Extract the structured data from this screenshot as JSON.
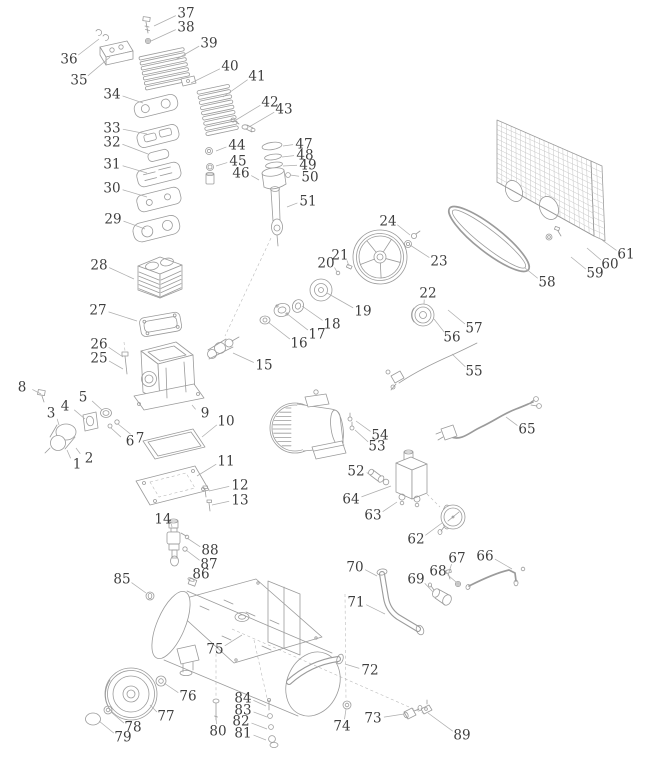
{
  "canvas": {
    "width": 656,
    "height": 768,
    "background": "#ffffff"
  },
  "style": {
    "part_line_color": "#9b9b9b",
    "mesh_line_color": "#c6c6c6",
    "leader_line_color": "#aeaeae",
    "label_color": "#3f3f3f",
    "label_font_size": 13.5
  },
  "diagram": {
    "kind": "exploded-parts-diagram",
    "subject": "belt-driven air compressor exploded view",
    "labels": [
      {
        "n": "1",
        "x": 77,
        "y": 464,
        "tx": 67,
        "ty": 450
      },
      {
        "n": "2",
        "x": 89,
        "y": 458,
        "tx": 76,
        "ty": 448
      },
      {
        "n": "3",
        "x": 51,
        "y": 413,
        "tx": 59,
        "ty": 425
      },
      {
        "n": "4",
        "x": 65,
        "y": 406,
        "tx": 85,
        "ty": 419
      },
      {
        "n": "5",
        "x": 83,
        "y": 397,
        "tx": 102,
        "ty": 410
      },
      {
        "n": "6",
        "x": 130,
        "y": 441,
        "tx": 111,
        "ty": 428
      },
      {
        "n": "7",
        "x": 140,
        "y": 438,
        "tx": 118,
        "ty": 424
      },
      {
        "n": "8",
        "x": 22,
        "y": 387,
        "tx": 41,
        "ty": 394
      },
      {
        "n": "9",
        "x": 205,
        "y": 413,
        "tx": 192,
        "ty": 405
      },
      {
        "n": "10",
        "x": 226,
        "y": 421,
        "tx": 202,
        "ty": 437
      },
      {
        "n": "11",
        "x": 226,
        "y": 461,
        "tx": 197,
        "ty": 476
      },
      {
        "n": "12",
        "x": 240,
        "y": 485,
        "tx": 209,
        "ty": 491
      },
      {
        "n": "13",
        "x": 240,
        "y": 500,
        "tx": 212,
        "ty": 505
      },
      {
        "n": "14",
        "x": 163,
        "y": 519,
        "tx": 172,
        "ty": 527
      },
      {
        "n": "15",
        "x": 264,
        "y": 365,
        "tx": 233,
        "ty": 353
      },
      {
        "n": "16",
        "x": 299,
        "y": 343,
        "tx": 268,
        "ty": 322
      },
      {
        "n": "17",
        "x": 317,
        "y": 334,
        "tx": 286,
        "ty": 313
      },
      {
        "n": "18",
        "x": 332,
        "y": 324,
        "tx": 302,
        "ty": 306
      },
      {
        "n": "19",
        "x": 363,
        "y": 311,
        "tx": 327,
        "ty": 293
      },
      {
        "n": "20",
        "x": 326,
        "y": 263,
        "tx": 337,
        "ty": 272
      },
      {
        "n": "21",
        "x": 340,
        "y": 255,
        "tx": 349,
        "ty": 266
      },
      {
        "n": "22",
        "x": 428,
        "y": 293,
        "tx": 424,
        "ty": 304
      },
      {
        "n": "23",
        "x": 439,
        "y": 261,
        "tx": 410,
        "ty": 245
      },
      {
        "n": "24",
        "x": 388,
        "y": 221,
        "tx": 410,
        "ty": 235
      },
      {
        "n": "25",
        "x": 99,
        "y": 358,
        "tx": 123,
        "ty": 369
      },
      {
        "n": "26",
        "x": 99,
        "y": 344,
        "tx": 123,
        "ty": 357
      },
      {
        "n": "27",
        "x": 98,
        "y": 310,
        "tx": 137,
        "ty": 321
      },
      {
        "n": "28",
        "x": 99,
        "y": 265,
        "tx": 134,
        "ty": 279
      },
      {
        "n": "29",
        "x": 113,
        "y": 219,
        "tx": 145,
        "ty": 229
      },
      {
        "n": "30",
        "x": 112,
        "y": 188,
        "tx": 147,
        "ty": 197
      },
      {
        "n": "31",
        "x": 112,
        "y": 164,
        "tx": 147,
        "ty": 173
      },
      {
        "n": "32",
        "x": 112,
        "y": 142,
        "tx": 148,
        "ty": 154
      },
      {
        "n": "33",
        "x": 112,
        "y": 128,
        "tx": 147,
        "ty": 134
      },
      {
        "n": "34",
        "x": 112,
        "y": 94,
        "tx": 143,
        "ty": 103
      },
      {
        "n": "35",
        "x": 79,
        "y": 80,
        "tx": 110,
        "ty": 57
      },
      {
        "n": "36",
        "x": 69,
        "y": 59,
        "tx": 99,
        "ty": 39
      },
      {
        "n": "37",
        "x": 186,
        "y": 13,
        "tx": 154,
        "ty": 26
      },
      {
        "n": "38",
        "x": 186,
        "y": 27,
        "tx": 151,
        "ty": 41
      },
      {
        "n": "39",
        "x": 209,
        "y": 43,
        "tx": 175,
        "ty": 60
      },
      {
        "n": "40",
        "x": 230,
        "y": 66,
        "tx": 191,
        "ty": 83
      },
      {
        "n": "41",
        "x": 257,
        "y": 76,
        "tx": 223,
        "ty": 97
      },
      {
        "n": "42",
        "x": 270,
        "y": 102,
        "tx": 236,
        "ty": 120
      },
      {
        "n": "43",
        "x": 284,
        "y": 109,
        "tx": 249,
        "ty": 127
      },
      {
        "n": "44",
        "x": 237,
        "y": 145,
        "tx": 216,
        "ty": 151
      },
      {
        "n": "45",
        "x": 238,
        "y": 161,
        "tx": 216,
        "ty": 166
      },
      {
        "n": "46",
        "x": 241,
        "y": 173,
        "tx": 259,
        "ty": 180
      },
      {
        "n": "47",
        "x": 304,
        "y": 144,
        "tx": 283,
        "ty": 146
      },
      {
        "n": "48",
        "x": 305,
        "y": 155,
        "tx": 282,
        "ty": 157
      },
      {
        "n": "49",
        "x": 308,
        "y": 165,
        "tx": 283,
        "ty": 166
      },
      {
        "n": "50",
        "x": 310,
        "y": 177,
        "tx": 290,
        "ty": 175
      },
      {
        "n": "51",
        "x": 308,
        "y": 201,
        "tx": 287,
        "ty": 207
      },
      {
        "n": "52",
        "x": 356,
        "y": 471,
        "tx": 369,
        "ty": 474
      },
      {
        "n": "53",
        "x": 377,
        "y": 446,
        "tx": 355,
        "ty": 430
      },
      {
        "n": "54",
        "x": 380,
        "y": 435,
        "tx": 356,
        "ty": 421
      },
      {
        "n": "55",
        "x": 474,
        "y": 371,
        "tx": 452,
        "ty": 354
      },
      {
        "n": "56",
        "x": 452,
        "y": 337,
        "tx": 434,
        "ty": 319
      },
      {
        "n": "57",
        "x": 474,
        "y": 328,
        "tx": 448,
        "ty": 310
      },
      {
        "n": "58",
        "x": 547,
        "y": 282,
        "tx": 525,
        "ty": 268
      },
      {
        "n": "59",
        "x": 595,
        "y": 273,
        "tx": 571,
        "ty": 257
      },
      {
        "n": "60",
        "x": 610,
        "y": 264,
        "tx": 587,
        "ty": 248
      },
      {
        "n": "61",
        "x": 626,
        "y": 254,
        "tx": 602,
        "ty": 240
      },
      {
        "n": "62",
        "x": 416,
        "y": 539,
        "tx": 442,
        "ty": 523
      },
      {
        "n": "63",
        "x": 373,
        "y": 515,
        "tx": 397,
        "ty": 502
      },
      {
        "n": "64",
        "x": 351,
        "y": 499,
        "tx": 391,
        "ty": 486
      },
      {
        "n": "65",
        "x": 527,
        "y": 429,
        "tx": 506,
        "ty": 417
      },
      {
        "n": "66",
        "x": 485,
        "y": 556,
        "tx": 512,
        "ty": 569
      },
      {
        "n": "67",
        "x": 457,
        "y": 558,
        "tx": 449,
        "ty": 572
      },
      {
        "n": "68",
        "x": 438,
        "y": 571,
        "tx": 456,
        "ty": 582
      },
      {
        "n": "69",
        "x": 416,
        "y": 579,
        "tx": 433,
        "ty": 592
      },
      {
        "n": "70",
        "x": 355,
        "y": 567,
        "tx": 377,
        "ty": 576
      },
      {
        "n": "71",
        "x": 356,
        "y": 602,
        "tx": 385,
        "ty": 614
      },
      {
        "n": "72",
        "x": 370,
        "y": 670,
        "tx": 345,
        "ty": 664
      },
      {
        "n": "73",
        "x": 373,
        "y": 718,
        "tx": 404,
        "ty": 714
      },
      {
        "n": "74",
        "x": 342,
        "y": 726,
        "tx": 346,
        "ty": 709
      },
      {
        "n": "75",
        "x": 215,
        "y": 649,
        "tx": 242,
        "ty": 635
      },
      {
        "n": "76",
        "x": 188,
        "y": 696,
        "tx": 164,
        "ty": 683
      },
      {
        "n": "77",
        "x": 166,
        "y": 716,
        "tx": 150,
        "ty": 705
      },
      {
        "n": "78",
        "x": 133,
        "y": 727,
        "tx": 111,
        "ty": 712
      },
      {
        "n": "79",
        "x": 123,
        "y": 737,
        "tx": 99,
        "ty": 721
      },
      {
        "n": "80",
        "x": 218,
        "y": 731,
        "tx": 216,
        "ty": 717
      },
      {
        "n": "81",
        "x": 243,
        "y": 733,
        "tx": 266,
        "ty": 740
      },
      {
        "n": "82",
        "x": 241,
        "y": 721,
        "tx": 267,
        "ty": 729
      },
      {
        "n": "83",
        "x": 243,
        "y": 710,
        "tx": 267,
        "ty": 717
      },
      {
        "n": "84",
        "x": 243,
        "y": 698,
        "tx": 266,
        "ty": 706
      },
      {
        "n": "85",
        "x": 122,
        "y": 579,
        "tx": 146,
        "ty": 593
      },
      {
        "n": "86",
        "x": 201,
        "y": 574,
        "tx": 194,
        "ty": 582
      },
      {
        "n": "87",
        "x": 209,
        "y": 564,
        "tx": 186,
        "ty": 550
      },
      {
        "n": "88",
        "x": 210,
        "y": 550,
        "tx": 187,
        "ty": 538
      },
      {
        "n": "89",
        "x": 462,
        "y": 735,
        "tx": 428,
        "ty": 713
      }
    ]
  }
}
